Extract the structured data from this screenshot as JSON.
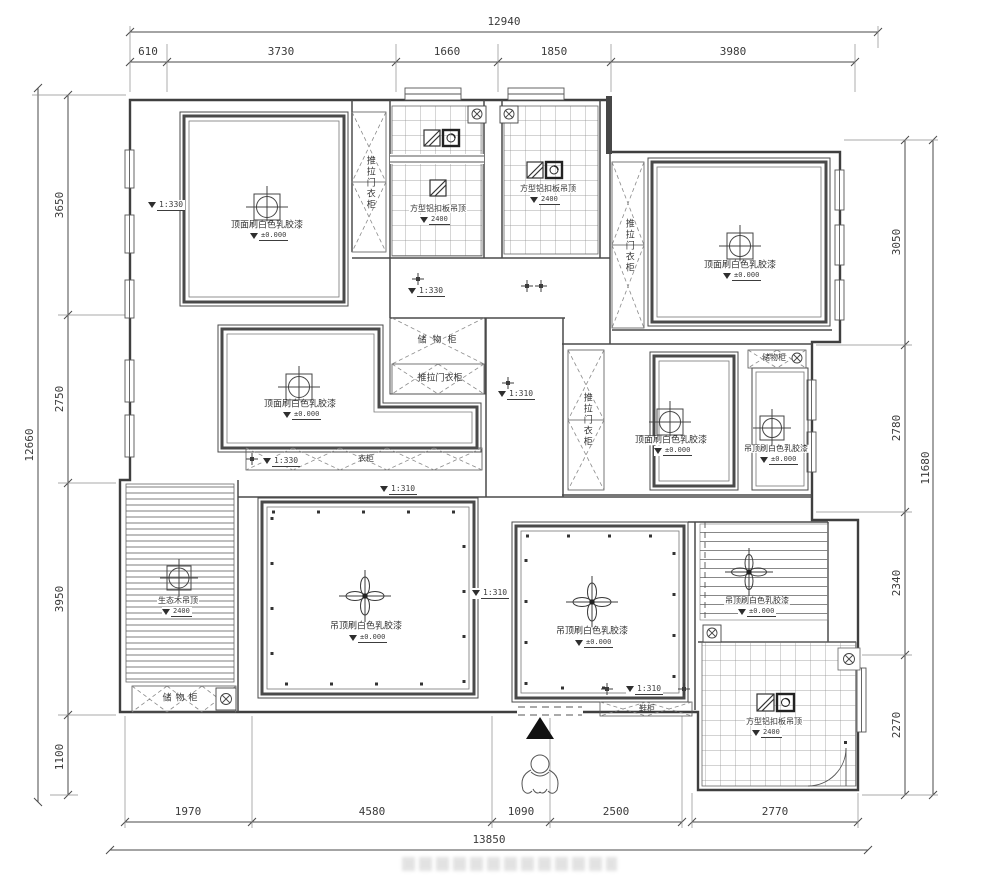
{
  "dimensions": {
    "top": {
      "total": "12940",
      "segments": [
        "610",
        "3730",
        "1660",
        "1850",
        "3980"
      ]
    },
    "bottom": {
      "total": "13850",
      "segments": [
        "1970",
        "4580",
        "1090",
        "2500",
        "2770"
      ]
    },
    "left": {
      "total": "12660",
      "segments": [
        "3650",
        "2750",
        "3950",
        "1100"
      ]
    },
    "right": {
      "total": "11680",
      "segments": [
        "3050",
        "2780",
        "2340",
        "2270"
      ]
    }
  },
  "rooms": {
    "bedroom_top_left": {
      "label": "顶面刷白色乳胶漆",
      "elevation": "±0.000"
    },
    "bedroom_top_right": {
      "label": "顶面刷白色乳胶漆",
      "elevation": "±0.000"
    },
    "bedroom_left": {
      "label": "顶面刷白色乳胶漆",
      "elevation": "±0.000"
    },
    "bedroom_right": {
      "label": "顶面刷白色乳胶漆",
      "elevation": "±0.000"
    },
    "study": {
      "label": "吊顶刷白色乳胶漆",
      "elevation": "±0.000"
    },
    "living_room": {
      "label": "吊顶刷白色乳胶漆",
      "elevation": "±0.000"
    },
    "dining_room": {
      "label": "吊顶刷白色乳胶漆",
      "elevation": "±0.000"
    },
    "hallway": {
      "label": "吊顶刷白色乳胶漆",
      "elevation": "±0.000"
    },
    "kitchen": {
      "label": "方型铝扣板吊顶",
      "height": "2400"
    },
    "bathroom": {
      "label": "方型铝扣板吊顶",
      "height": "2400"
    },
    "kitchen_south": {
      "label": "方型铝扣板吊顶",
      "height": "2400"
    },
    "balcony": {
      "label": "生态木吊顶",
      "height": "2400"
    }
  },
  "cabinets": {
    "wardrobe_top_left": "推拉门衣柜",
    "wardrobe_top_right": "推拉门衣柜",
    "wardrobe_right": "推拉门衣柜",
    "storage_center": "储物柜",
    "wardrobe_center": "推拉门衣柜",
    "closet_center": "衣柜",
    "storage_balcony": "储物柜",
    "shoe_cabinet": "鞋柜",
    "storage_right": "储物柜"
  },
  "level_markers": {
    "m1": "1:330",
    "m2": "1:330",
    "m3": "1:310",
    "m4": "1:330",
    "m5": "1:310",
    "m6": "1:310",
    "m7": "1:310"
  }
}
